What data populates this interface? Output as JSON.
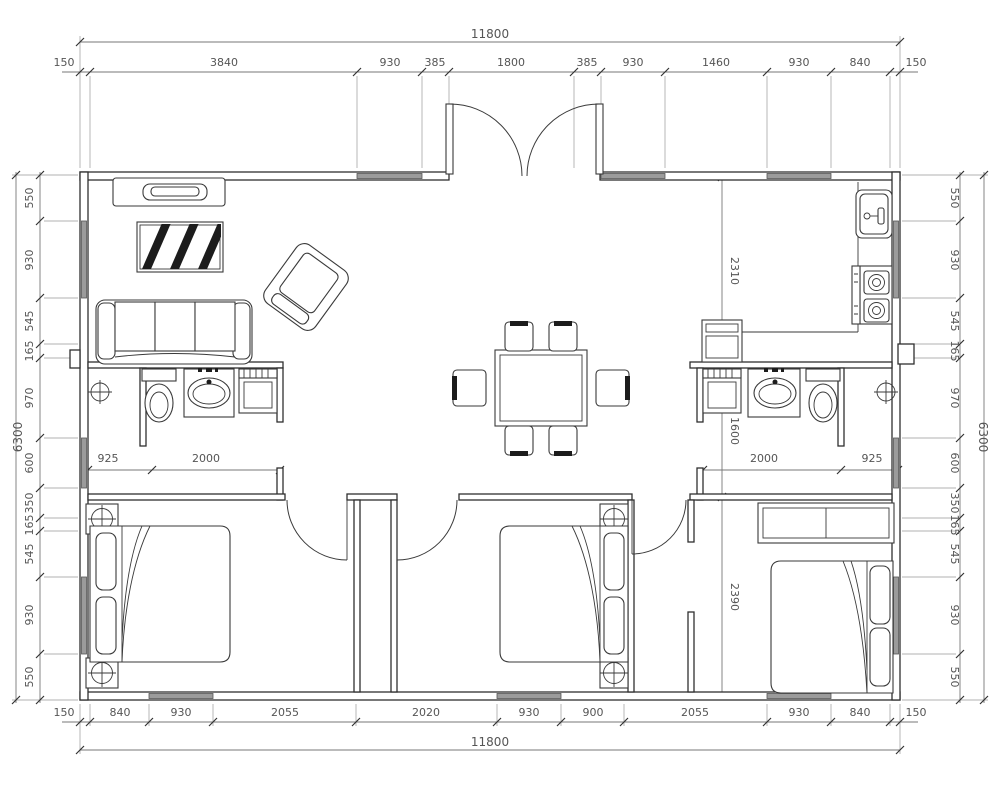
{
  "meta": {
    "drawing_type": "residential floor plan",
    "units": "mm",
    "symbols": [
      "sofa",
      "armchair",
      "tv-cabinet",
      "hatched-rug",
      "dining-table",
      "dining-chair",
      "kitchen-sink",
      "stove",
      "toilet",
      "wash-basin",
      "washer-cabinet",
      "floor-drain",
      "bed",
      "nightstand",
      "lamp",
      "wardrobe",
      "double-entry-door",
      "swing-door",
      "window"
    ]
  },
  "dims": {
    "top": {
      "overall": "11800",
      "chain": [
        "150",
        "3840",
        "930",
        "385",
        "1800",
        "385",
        "930",
        "1460",
        "930",
        "840",
        "150"
      ]
    },
    "bottom": {
      "overall": "11800",
      "chain": [
        "150",
        "840",
        "930",
        "2055",
        "2020",
        "930",
        "900",
        "2055",
        "930",
        "840",
        "150"
      ]
    },
    "left": {
      "overall": "6300",
      "chain": [
        "550",
        "930",
        "545",
        "165",
        "970",
        "600",
        "350",
        "165",
        "545",
        "930",
        "550"
      ]
    },
    "right": {
      "overall": "6300",
      "chain": [
        "550",
        "930",
        "545",
        "165",
        "970",
        "600",
        "350",
        "165",
        "545",
        "930",
        "550"
      ]
    },
    "inner": {
      "vchain": [
        "2310",
        "1600",
        "2390"
      ],
      "bath_left": [
        "925",
        "2000"
      ],
      "bath_right": [
        "2000",
        "925"
      ]
    }
  }
}
